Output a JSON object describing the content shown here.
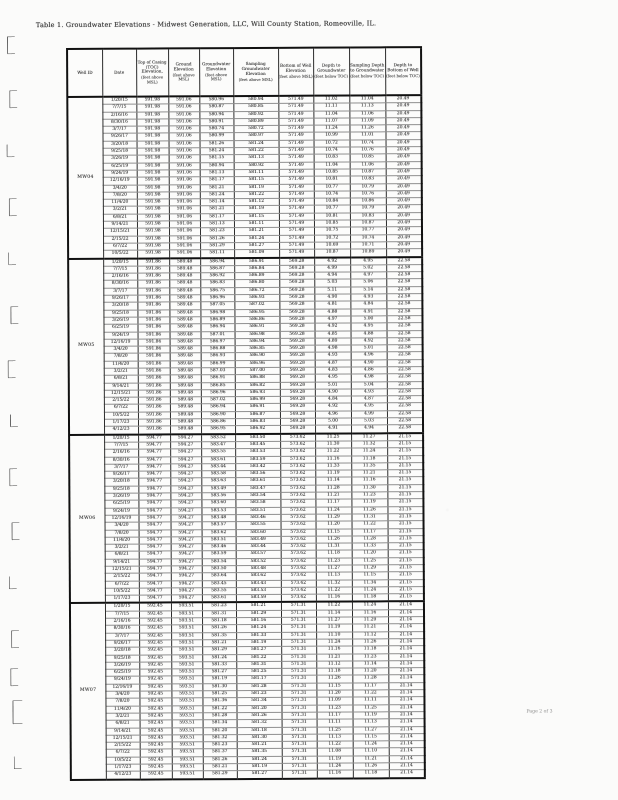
{
  "title": "Table 1. Groundwater Elevations - Midwest Generation, LLC, Will County Station, Romeoville, IL.",
  "footer": {
    "page_label": "Page 2 of 3"
  },
  "colors": {
    "ink": "#3a3a3a",
    "table_line": "#2b2b2b",
    "row_line": "#8f8f8f",
    "paper": "#fbfbfa"
  },
  "table": {
    "columns": [
      {
        "label": "Well ID",
        "unit": ""
      },
      {
        "label": "Date",
        "unit": ""
      },
      {
        "label": "Top of Casing (TOC) Elevation,",
        "unit": "(feet above MSL)"
      },
      {
        "label": "Ground Elevation",
        "unit": "(feet above MSL)"
      },
      {
        "label": "Groundwater Elevation",
        "unit": "(feet above MSL)"
      },
      {
        "label": "Sampling Groundwater Elevation",
        "unit": "(feet above MSL)"
      },
      {
        "label": "Bottom of Well Elevation",
        "unit": "(feet above MSL)"
      },
      {
        "label": "Depth to Groundwater",
        "unit": "(feet below TOC)"
      },
      {
        "label": "Sampling Depth to Groundwater",
        "unit": "(feet below TOC)"
      },
      {
        "label": "Depth to Bottom of Well",
        "unit": "(feet below TOC)"
      }
    ],
    "row_fields": [
      "date",
      "groundwater_elevation",
      "sampling_groundwater_elevation",
      "depth_to_groundwater",
      "sampling_depth_to_groundwater"
    ],
    "sections": [
      {
        "well_id": "MW04",
        "toc_elevation": "591.98",
        "ground_elevation": "591.06",
        "bottom_of_well_elevation": "571.49",
        "depth_to_bottom_of_well": "20.49",
        "rows": [
          [
            "1/20/15",
            "580.96",
            "580.94",
            "11.02",
            "11.04"
          ],
          [
            "7/7/15",
            "580.87",
            "580.85",
            "11.11",
            "11.13"
          ],
          [
            "2/16/16",
            "580.94",
            "580.92",
            "11.04",
            "11.06"
          ],
          [
            "8/30/16",
            "580.91",
            "580.89",
            "11.07",
            "11.09"
          ],
          [
            "3/7/17",
            "580.74",
            "580.72",
            "11.24",
            "11.26"
          ],
          [
            "9/26/17",
            "580.99",
            "580.97",
            "10.99",
            "11.01"
          ],
          [
            "3/20/18",
            "581.26",
            "581.24",
            "10.72",
            "10.74"
          ],
          [
            "9/25/18",
            "581.24",
            "581.22",
            "10.74",
            "10.76"
          ],
          [
            "3/26/19",
            "581.15",
            "581.13",
            "10.83",
            "10.85"
          ],
          [
            "6/25/19",
            "580.94",
            "580.92",
            "11.04",
            "11.06"
          ],
          [
            "9/24/19",
            "581.13",
            "581.11",
            "10.85",
            "10.87"
          ],
          [
            "12/16/19",
            "581.17",
            "581.15",
            "10.81",
            "10.83"
          ],
          [
            "3/4/20",
            "581.21",
            "581.19",
            "10.77",
            "10.79"
          ],
          [
            "7/8/20",
            "581.24",
            "581.22",
            "10.74",
            "10.76"
          ],
          [
            "11/4/20",
            "581.14",
            "581.12",
            "10.84",
            "10.86"
          ],
          [
            "3/2/21",
            "581.21",
            "581.19",
            "10.77",
            "10.79"
          ],
          [
            "6/8/21",
            "581.17",
            "581.15",
            "10.81",
            "10.83"
          ],
          [
            "9/14/21",
            "581.13",
            "581.11",
            "10.85",
            "10.87"
          ],
          [
            "12/15/21",
            "581.23",
            "581.21",
            "10.75",
            "10.77"
          ],
          [
            "2/15/22",
            "581.26",
            "581.24",
            "10.72",
            "10.74"
          ],
          [
            "6/7/22",
            "581.29",
            "581.27",
            "10.69",
            "10.71"
          ],
          [
            "10/5/22",
            "581.11",
            "581.09",
            "10.87",
            "10.89"
          ]
        ]
      },
      {
        "well_id": "MW05",
        "toc_elevation": "591.86",
        "ground_elevation": "589.48",
        "bottom_of_well_elevation": "569.28",
        "depth_to_bottom_of_well": "22.58",
        "rows": [
          [
            "1/20/15",
            "586.94",
            "586.91",
            "4.92",
            "4.95"
          ],
          [
            "7/7/15",
            "586.87",
            "586.84",
            "4.99",
            "5.02"
          ],
          [
            "2/16/16",
            "586.92",
            "586.89",
            "4.94",
            "4.97"
          ],
          [
            "8/30/16",
            "586.83",
            "586.80",
            "5.03",
            "5.06"
          ],
          [
            "3/7/17",
            "586.75",
            "586.72",
            "5.11",
            "5.14"
          ],
          [
            "9/26/17",
            "586.96",
            "586.93",
            "4.90",
            "4.93"
          ],
          [
            "3/20/18",
            "587.05",
            "587.02",
            "4.81",
            "4.84"
          ],
          [
            "9/25/18",
            "586.98",
            "586.95",
            "4.88",
            "4.91"
          ],
          [
            "3/26/19",
            "586.89",
            "586.86",
            "4.97",
            "5.00"
          ],
          [
            "6/25/19",
            "586.94",
            "586.91",
            "4.92",
            "4.95"
          ],
          [
            "9/24/19",
            "587.01",
            "586.98",
            "4.85",
            "4.88"
          ],
          [
            "12/16/19",
            "586.97",
            "586.94",
            "4.89",
            "4.92"
          ],
          [
            "3/4/20",
            "586.88",
            "586.85",
            "4.98",
            "5.01"
          ],
          [
            "7/8/20",
            "586.93",
            "586.90",
            "4.93",
            "4.96"
          ],
          [
            "11/4/20",
            "586.99",
            "586.96",
            "4.87",
            "4.90"
          ],
          [
            "3/2/21",
            "587.03",
            "587.00",
            "4.83",
            "4.86"
          ],
          [
            "6/8/21",
            "586.91",
            "586.88",
            "4.95",
            "4.98"
          ],
          [
            "9/14/21",
            "586.85",
            "586.82",
            "5.01",
            "5.04"
          ],
          [
            "12/15/21",
            "586.96",
            "586.93",
            "4.90",
            "4.93"
          ],
          [
            "2/15/22",
            "587.02",
            "586.99",
            "4.84",
            "4.87"
          ],
          [
            "6/7/22",
            "586.94",
            "586.91",
            "4.92",
            "4.95"
          ],
          [
            "10/5/22",
            "586.90",
            "586.87",
            "4.96",
            "4.99"
          ],
          [
            "1/17/23",
            "586.86",
            "586.83",
            "5.00",
            "5.03"
          ],
          [
            "4/12/23",
            "586.95",
            "586.92",
            "4.91",
            "4.94"
          ]
        ]
      },
      {
        "well_id": "MW06",
        "toc_elevation": "594.77",
        "ground_elevation": "594.27",
        "bottom_of_well_elevation": "573.62",
        "depth_to_bottom_of_well": "21.15",
        "rows": [
          [
            "1/20/15",
            "583.52",
            "583.50",
            "11.25",
            "11.27"
          ],
          [
            "7/7/15",
            "583.47",
            "583.45",
            "11.30",
            "11.32"
          ],
          [
            "2/16/16",
            "583.55",
            "583.53",
            "11.22",
            "11.24"
          ],
          [
            "8/30/16",
            "583.61",
            "583.59",
            "11.16",
            "11.18"
          ],
          [
            "3/7/17",
            "583.44",
            "583.42",
            "11.33",
            "11.35"
          ],
          [
            "9/26/17",
            "583.58",
            "583.56",
            "11.19",
            "11.21"
          ],
          [
            "3/20/18",
            "583.63",
            "583.61",
            "11.14",
            "11.16"
          ],
          [
            "9/25/18",
            "583.49",
            "583.47",
            "11.28",
            "11.30"
          ],
          [
            "3/26/19",
            "583.56",
            "583.54",
            "11.21",
            "11.23"
          ],
          [
            "6/25/19",
            "583.60",
            "583.58",
            "11.17",
            "11.19"
          ],
          [
            "9/24/19",
            "583.53",
            "583.51",
            "11.24",
            "11.26"
          ],
          [
            "12/16/19",
            "583.48",
            "583.46",
            "11.29",
            "11.31"
          ],
          [
            "3/4/20",
            "583.57",
            "583.55",
            "11.20",
            "11.22"
          ],
          [
            "7/8/20",
            "583.62",
            "583.60",
            "11.15",
            "11.17"
          ],
          [
            "11/4/20",
            "583.51",
            "583.49",
            "11.26",
            "11.28"
          ],
          [
            "3/2/21",
            "583.46",
            "583.44",
            "11.31",
            "11.33"
          ],
          [
            "6/8/21",
            "583.59",
            "583.57",
            "11.18",
            "11.20"
          ],
          [
            "9/14/21",
            "583.54",
            "583.52",
            "11.23",
            "11.25"
          ],
          [
            "12/15/21",
            "583.50",
            "583.48",
            "11.27",
            "11.29"
          ],
          [
            "2/15/22",
            "583.64",
            "583.62",
            "11.13",
            "11.15"
          ],
          [
            "6/7/22",
            "583.45",
            "583.43",
            "11.32",
            "11.34"
          ],
          [
            "10/5/22",
            "583.55",
            "583.53",
            "11.22",
            "11.24"
          ],
          [
            "1/17/23",
            "583.61",
            "583.59",
            "11.16",
            "11.18"
          ]
        ]
      },
      {
        "well_id": "MW07",
        "toc_elevation": "592.45",
        "ground_elevation": "593.51",
        "bottom_of_well_elevation": "571.31",
        "depth_to_bottom_of_well": "21.14",
        "rows": [
          [
            "1/20/15",
            "581.23",
            "581.21",
            "11.22",
            "11.24"
          ],
          [
            "7/7/15",
            "581.31",
            "581.29",
            "11.14",
            "11.16"
          ],
          [
            "2/16/16",
            "581.18",
            "581.16",
            "11.27",
            "11.29"
          ],
          [
            "8/30/16",
            "581.26",
            "581.24",
            "11.19",
            "11.21"
          ],
          [
            "3/7/17",
            "581.35",
            "581.33",
            "11.10",
            "11.12"
          ],
          [
            "9/26/17",
            "581.21",
            "581.19",
            "11.24",
            "11.26"
          ],
          [
            "3/20/18",
            "581.29",
            "581.27",
            "11.16",
            "11.18"
          ],
          [
            "9/25/18",
            "581.24",
            "581.22",
            "11.21",
            "11.23"
          ],
          [
            "3/26/19",
            "581.33",
            "581.31",
            "11.12",
            "11.14"
          ],
          [
            "6/25/19",
            "581.27",
            "581.25",
            "11.18",
            "11.20"
          ],
          [
            "9/24/19",
            "581.19",
            "581.17",
            "11.26",
            "11.28"
          ],
          [
            "12/16/19",
            "581.30",
            "581.28",
            "11.15",
            "11.17"
          ],
          [
            "3/4/20",
            "581.25",
            "581.23",
            "11.20",
            "11.22"
          ],
          [
            "7/8/20",
            "581.36",
            "581.34",
            "11.09",
            "11.11"
          ],
          [
            "11/4/20",
            "581.22",
            "581.20",
            "11.23",
            "11.25"
          ],
          [
            "3/2/21",
            "581.28",
            "581.26",
            "11.17",
            "11.19"
          ],
          [
            "6/8/21",
            "581.34",
            "581.32",
            "11.11",
            "11.13"
          ],
          [
            "9/14/21",
            "581.20",
            "581.18",
            "11.25",
            "11.27"
          ],
          [
            "12/15/21",
            "581.32",
            "581.30",
            "11.13",
            "11.15"
          ],
          [
            "2/15/22",
            "581.23",
            "581.21",
            "11.22",
            "11.24"
          ],
          [
            "6/7/22",
            "581.37",
            "581.35",
            "11.08",
            "11.10"
          ],
          [
            "10/5/22",
            "581.26",
            "581.24",
            "11.19",
            "11.21"
          ],
          [
            "1/17/23",
            "581.21",
            "581.19",
            "11.24",
            "11.26"
          ],
          [
            "4/12/23",
            "581.29",
            "581.27",
            "11.16",
            "11.18"
          ]
        ]
      }
    ]
  }
}
